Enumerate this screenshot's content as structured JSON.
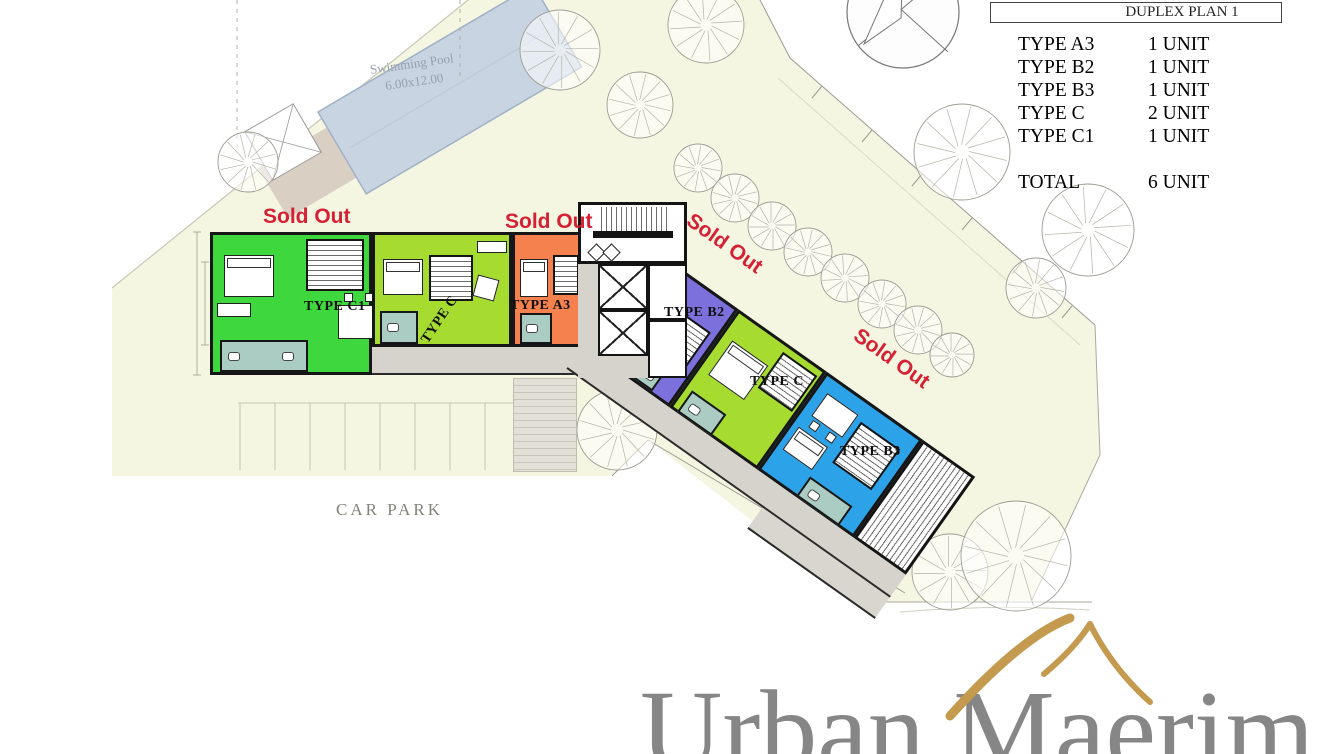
{
  "table": {
    "header": "DUPLEX PLAN 1",
    "rows": [
      {
        "type": "TYPE A3",
        "count": "1 UNIT"
      },
      {
        "type": "TYPE B2",
        "count": "1 UNIT"
      },
      {
        "type": "TYPE B3",
        "count": "1 UNIT"
      },
      {
        "type": "TYPE C",
        "count": "2 UNIT"
      },
      {
        "type": "TYPE C1",
        "count": "1 UNIT"
      }
    ],
    "total": {
      "label": "TOTAL",
      "count": "6 UNIT"
    }
  },
  "labels": {
    "sold_out": "Sold Out",
    "car_park": "CAR PARK",
    "swimming_pool": "Swimming Pool",
    "pool_size": "6.00x12.00"
  },
  "units": [
    {
      "label": "TYPE C1",
      "color": "#3ed83e",
      "status": "Sold Out"
    },
    {
      "label": "TYPE C",
      "color": "#a6dc30",
      "status": ""
    },
    {
      "label": "TYPE A3",
      "color": "#f5814e",
      "status": "Sold Out"
    },
    {
      "label": "TYPE B2",
      "color": "#7b70dc",
      "status": "Sold Out"
    },
    {
      "label": "TYPE C",
      "color": "#a6dc30",
      "status": ""
    },
    {
      "label": "TYPE B3",
      "color": "#2ca3e9",
      "status": "Sold Out"
    }
  ],
  "logo": {
    "name": "Urban Maerim"
  },
  "colors": {
    "sold_out_red": "#d52133",
    "site_fill": "#f5f6e2",
    "pool_fill": "#c8d4e2",
    "deck_tan": "#d9cfc3",
    "corridor_gray": "#d6d2cc",
    "bathroom_teal": "#abccc3",
    "wall_black": "#161616",
    "logo_gray": "#868686",
    "logo_gold": "#c49a4e"
  }
}
